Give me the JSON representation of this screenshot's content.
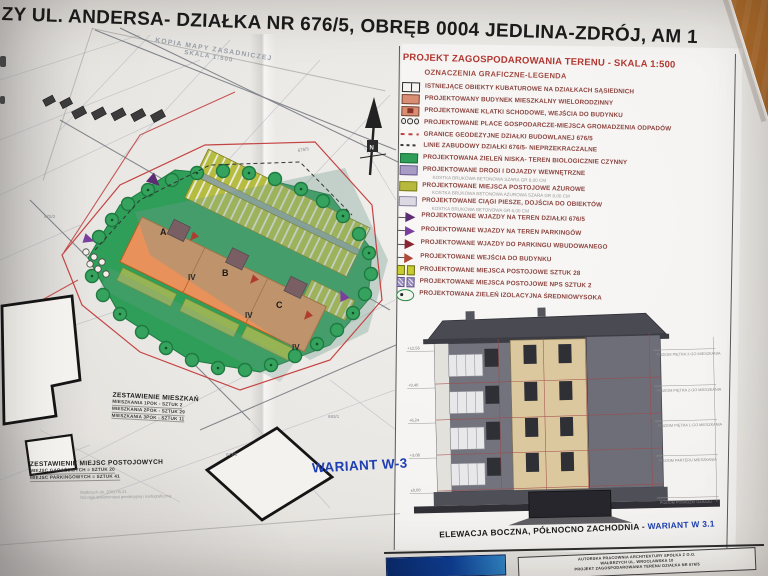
{
  "page_title": "ZY UL.  ANDERSA- DZIAŁKA NR 676/5, OBRĘB 0004 JEDLINA-ZDRÓJ, AM 1",
  "map": {
    "header_line1": "KOPIA MAPY ZASADNICZEJ",
    "header_line2": "SKALA 1:500",
    "north_label": "N",
    "variant_label": "WARIANT W-3",
    "building_sections": [
      "A",
      "B",
      "C"
    ],
    "storey_labels": [
      "IV",
      "IV",
      "IV"
    ],
    "parcel_labels": [
      "676/5",
      "677/3",
      "675/2",
      "693/1"
    ],
    "apartments_table": {
      "title": "ZESTAWIENIE MIESZKAŃ",
      "rows": [
        "MIESZKANIA 1POK - SZTUK 2",
        "MIESZKANIA 2POK - SZTUK 29",
        "MIESZKANIA 3POK - SZTUK 11"
      ]
    },
    "parking_table": {
      "title": "ZESTAWIENIE MIEJSC POSTOJOWYCH",
      "rows": [
        "MIEJSC GARAŻOWYCH = SZTUK 20",
        "MIEJSC PARKINGOWYCH = SZTUK 41"
      ]
    },
    "stamp_line1": "Wałbrzych dn. 2001-05-21",
    "stamp_line2": "Ośrodek dokumentacji geodezyjnej i kartograficznej"
  },
  "legend": {
    "title": "PROJEKT ZAGOSPODAROWANIA TERENU - SKALA 1:500",
    "subtitle": "OZNACZENIA GRAFICZNE-LEGENDA",
    "items": [
      {
        "swatch": "outline",
        "label": "ISTNIEJĄCE OBIEKTY KUBATUROWE NA DZIAŁKACH SĄSIEDNICH"
      },
      {
        "swatch": "salmon",
        "label": "PROJEKTOWANY BUDYNEK MIESZKALNY WIELORODZINNY"
      },
      {
        "swatch": "salmon-dark",
        "label": "PROJEKTOWANE KLATKI SCHODOWE, WEJŚCIA DO BUDYNKU"
      },
      {
        "swatch": "circles",
        "label": "PROJEKTOWANE PLACE GOSPODARCZE-MIEJSCA GROMADZENIA ODPADÓW"
      },
      {
        "swatch": "dash-red",
        "label": "GRANICE GEODEZYJNE DZIAŁKI BUDOWLANEJ 676/5"
      },
      {
        "swatch": "dash-black",
        "label": "LINIE ZABUDOWY DZIAŁKI 676/5- NIEPRZEKRACZALNE"
      },
      {
        "swatch": "fill-green",
        "label": "PROJEKTOWANA ZIELEŃ NISKA- TEREN BIOLOGICZNIE CZYNNY"
      },
      {
        "swatch": "fill-violet",
        "label": "PROJEKTOWANE DROGI I DOJAZDY WEWNĘTRZNE",
        "sub": "KOSTKA BRUKOWA BETONOWA SZARA GR 8,00 CM"
      },
      {
        "swatch": "fill-olive",
        "label": "PROJEKTOWANE MIEJSCA POSTOJOWE AŻUROWE",
        "sub": "KOSTKA BRUKOWA BETONOWA AŻUROWA SZARA GR 8,00 CM"
      },
      {
        "swatch": "fill-light",
        "label": "PROJEKTOWANE CIĄGI PIESZE, DOJŚCIA DO OBIEKTÓW",
        "sub": "KOSTKA BRUKOWA BETONOWA GR 6,00 CM"
      },
      {
        "swatch": "arrow-darkpurple",
        "label": "PROJEKTOWANE WJAZDY NA TEREN DZIAŁKI 676/5"
      },
      {
        "swatch": "arrow-purple",
        "label": "PROJEKTOWANE WJAZDY NA TEREN PARKINGÓW"
      },
      {
        "swatch": "arrow-darkred",
        "label": "PROJEKTOWANE WJAZDY DO PARKINGU WBUDOWANEGO"
      },
      {
        "swatch": "arrow-red",
        "label": "PROJEKTOWANE WEJŚCIA DO BUDYNKU"
      },
      {
        "swatch": "pair-olive",
        "label": "PROJEKTOWANE MIEJSCA POSTOJOWE SZTUK 28"
      },
      {
        "swatch": "pair-violet",
        "label": "PROJEKTOWANE MIEJSCA POSTOJOWE NPS SZTUK 2"
      },
      {
        "swatch": "tree",
        "label": "PROJEKTOWANA ZIELEŃ IZOLACYJNA ŚREDNIOWYSOKA"
      }
    ]
  },
  "elevation": {
    "caption_main": "ELEWACJA BOCZNA, PÓŁNOCNO ZACHODNIA - ",
    "caption_variant": "WARIANT W 3.1",
    "left_levels": [
      "+12,56",
      "+9,40",
      "+6,24",
      "+3,08",
      "±0,00"
    ],
    "right_levels": [
      "POZIOM PIĘTRA 3-GO MIESZKANIA",
      "POZIOM PIĘTRA 2-GO MIESZKANIA",
      "POZIOM PIĘTRA 1-GO MIESZKANIA",
      "POZIOM PARTERU MIESZKANIA",
      "POZIOM POSADZKI GARAŻU"
    ]
  },
  "title_block": {
    "line1": "AUTORSKA PRACOWNIA ARCHITEKTURY SPÓŁKA Z O.O.",
    "line2": "WAŁBRZYCH UL. WROCŁAWSKA 10",
    "line3": "PROJEKT ZAGOSPODAROWANIA TERENU DZIAŁKA NR 676/5"
  },
  "colors": {
    "legend_red": "#b23832",
    "variant_blue": "#1d3fb0",
    "site_green": "#2f9e58",
    "building_orange": "#e8915a",
    "parking_olive": "#b6bc40",
    "wood": "#b0722e"
  }
}
